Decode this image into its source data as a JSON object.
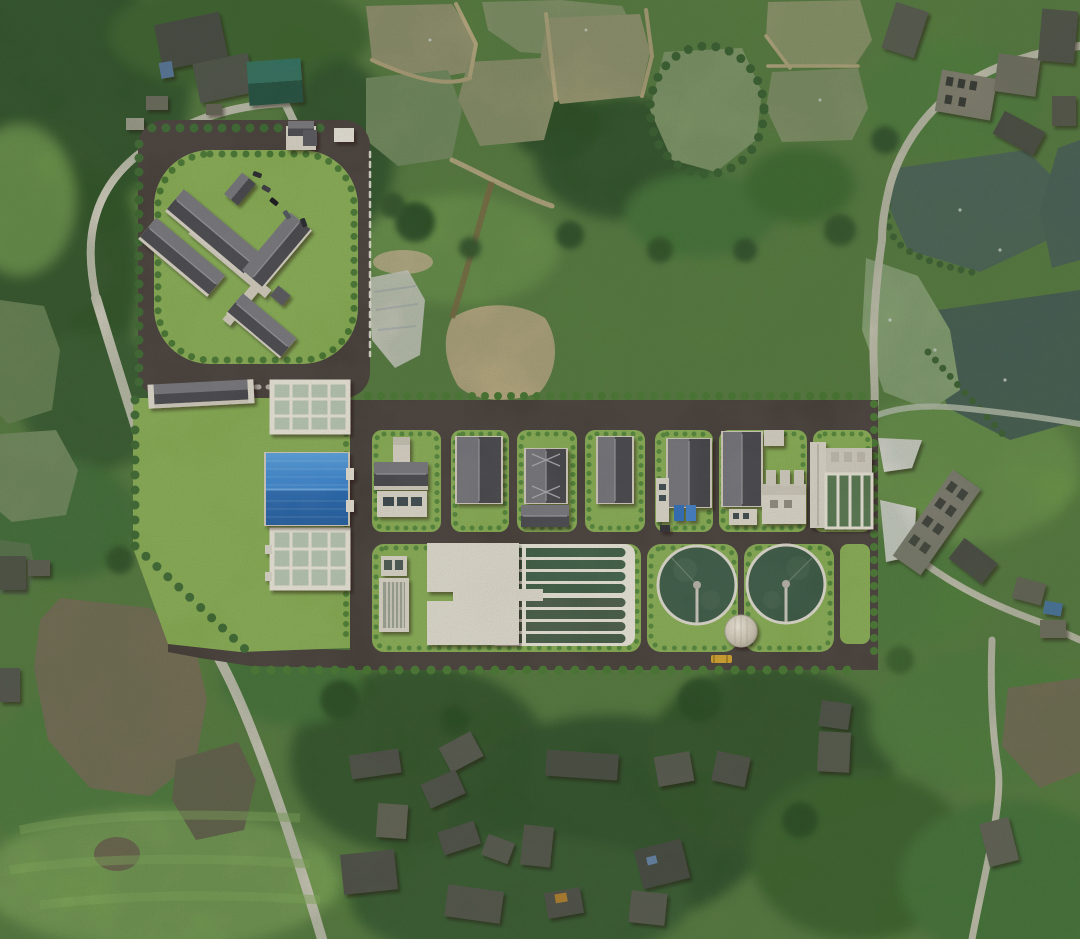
{
  "meta": {
    "title": "Aerial drone photograph with photorealistic site-plan rendering of a wastewater treatment plant composited into farmland",
    "canvas": {
      "width": 1080,
      "height": 939
    }
  },
  "palette": {
    "baseGreen": "#5d8342",
    "meadow": "#6f9a4d",
    "meadowLight": "#7ba457",
    "forest": "#3a6130",
    "forestDark": "#2e5126",
    "treeDark": "#3c672f",
    "hedge": "#4f8034",
    "lawn": "#85ab50",
    "asphalt": "#463e38",
    "roadLight": "#d8d3c3",
    "dike": "#c6b489",
    "sand": "#c7b48a",
    "tarp": "#e3e0d6",
    "pondMuddy": "#a09c77",
    "pondMuddy2": "#8d9c6e",
    "pondOlive": "#7c9465",
    "pondRound": "#8aa06f",
    "pondTeal": "#51695e",
    "pondTealDark": "#4a6158",
    "pondLight": "#93ad7c",
    "pondBrown": "#7e735a",
    "pondDark": "#6b6550",
    "wall": "#d7d1c3",
    "slab": "#dedacc",
    "roofLight": "#74747a",
    "roofDark": "#47474c",
    "tealRoof": "#2f6f5c",
    "cellWater": "#b6c4b0",
    "channelWater": "#3f5e45",
    "clarifierWater": "#3b5944",
    "blueRoofLight": "#3c86cf",
    "blueRoofDark": "#2465a8",
    "containerBlue": "#2e6cb8",
    "truckYellow": "#d2a02a",
    "fence": "#e6e2d6"
  },
  "scene": {
    "surroundings": {
      "fish_ponds": 14,
      "village_clusters": [
        "top-left",
        "top-right",
        "right",
        "bottom-center",
        "bottom-right"
      ],
      "features": [
        "winding light rural roads",
        "dense tree cover",
        "bare sand patches beside site",
        "white construction tarps"
      ]
    },
    "plant": {
      "admin_campus": {
        "building_wings": 4,
        "gatehouse": 1,
        "parked_cars": 5,
        "dark_paved_plaza": true,
        "rounded_lawn_with_hedge_ring": true
      },
      "left_field": {
        "grid_tanks": 2,
        "grid_tank_layout": "4 x 3 cells",
        "blue_roof_building": 1,
        "long_storage_building": 1
      },
      "process_row_buildings": 7,
      "blue_containers": 2,
      "oxidation_ditch": {
        "channel_groups": 2,
        "channels_per_group": 4,
        "concrete_platform": true,
        "inlet_screen_structure": 1
      },
      "circular_clarifiers": 2,
      "cylindrical_tank": 1,
      "filter_battery_cells": 4,
      "yellow_vehicle": 1
    }
  }
}
